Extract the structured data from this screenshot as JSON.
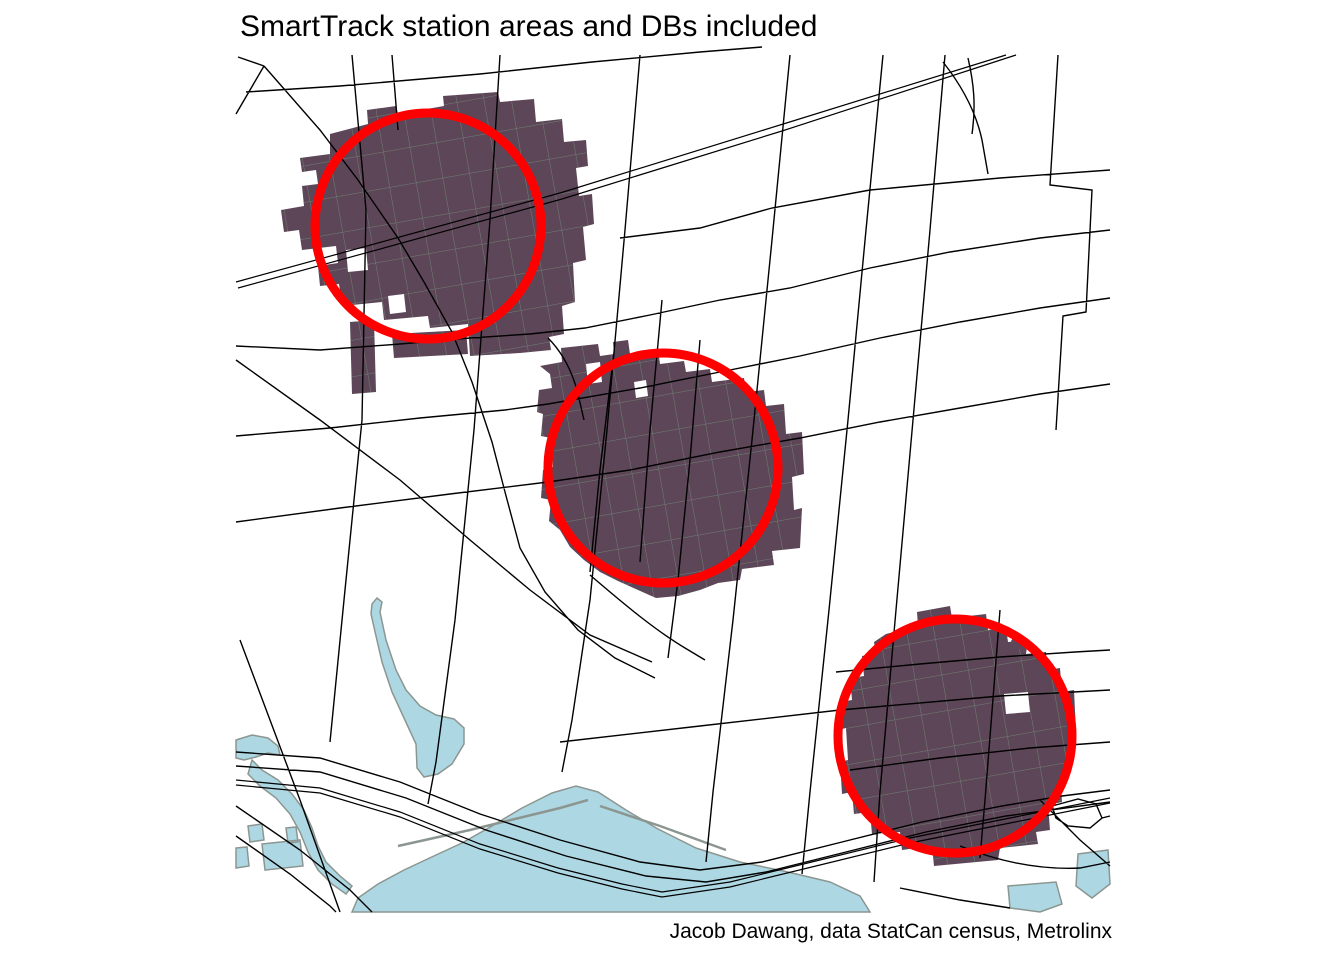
{
  "figure": {
    "title": "SmartTrack station areas and DBs included",
    "caption": "Jacob Dawang, data StatCan census, Metrolinx"
  },
  "colors": {
    "background": "#ffffff",
    "road_line": "#000000",
    "railway_line": "#000000",
    "station_area_fill": "#5e4659",
    "db_boundary_line": "#6e8071",
    "station_radius_circle": "#ff0000",
    "water_fill": "#add8e3",
    "water_outline": "#8c9691",
    "text": "#000000"
  },
  "map": {
    "stations": [
      {
        "position": "northwest",
        "center_x": 428,
        "center_y": 226,
        "radius_px": 113
      },
      {
        "position": "central",
        "center_x": 663,
        "center_y": 468,
        "radius_px": 115
      },
      {
        "position": "southeast",
        "center_x": 955,
        "center_y": 736,
        "radius_px": 117
      }
    ]
  }
}
